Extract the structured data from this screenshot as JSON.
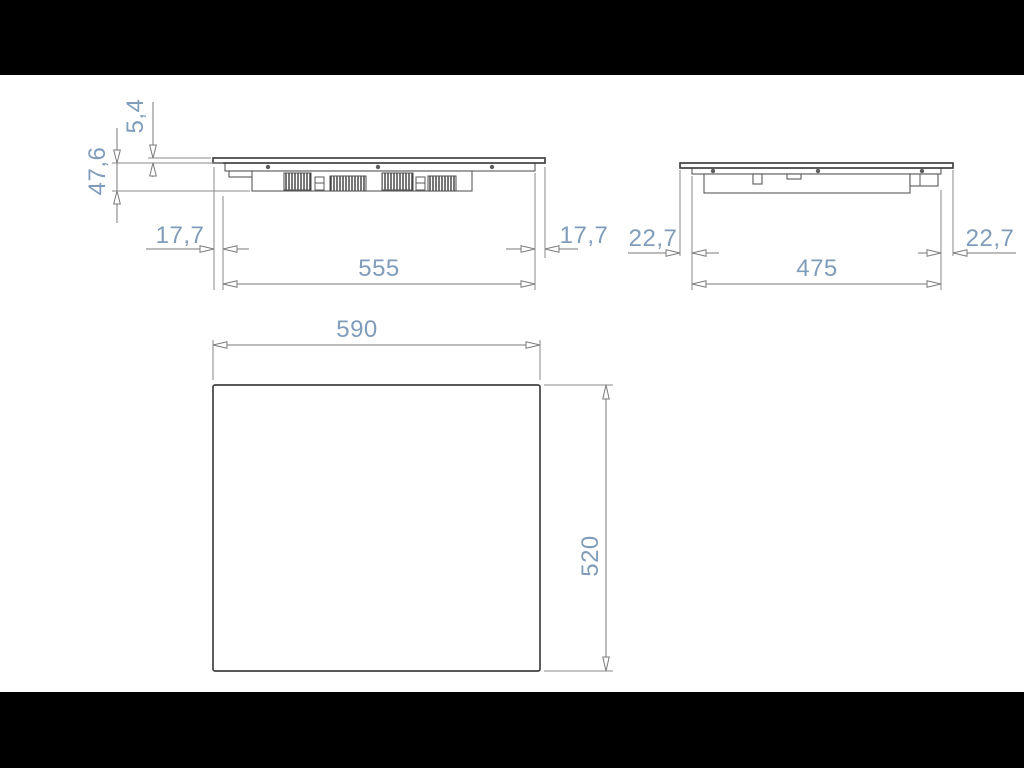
{
  "figure": {
    "kind": "technical-dimension-drawing",
    "subject": "built-in cooktop installation drawing",
    "units": "mm",
    "text_color": "#7f9cba",
    "line_color": "#7a7a7a",
    "background": "#000000",
    "sheet_color": "#ffffff"
  },
  "views": {
    "front": {
      "label": "front-section-view",
      "dims": {
        "glass_thickness": "5,4",
        "total_height": "47,6",
        "left_overhang": "17,7",
        "body_width": "555",
        "right_overhang": "17,7"
      }
    },
    "side": {
      "label": "side-section-view",
      "dims": {
        "left_overhang": "22,7",
        "body_width": "475",
        "right_overhang": "22,7"
      }
    },
    "plan": {
      "label": "plan-view",
      "dims": {
        "width": "590",
        "depth": "520"
      }
    }
  }
}
